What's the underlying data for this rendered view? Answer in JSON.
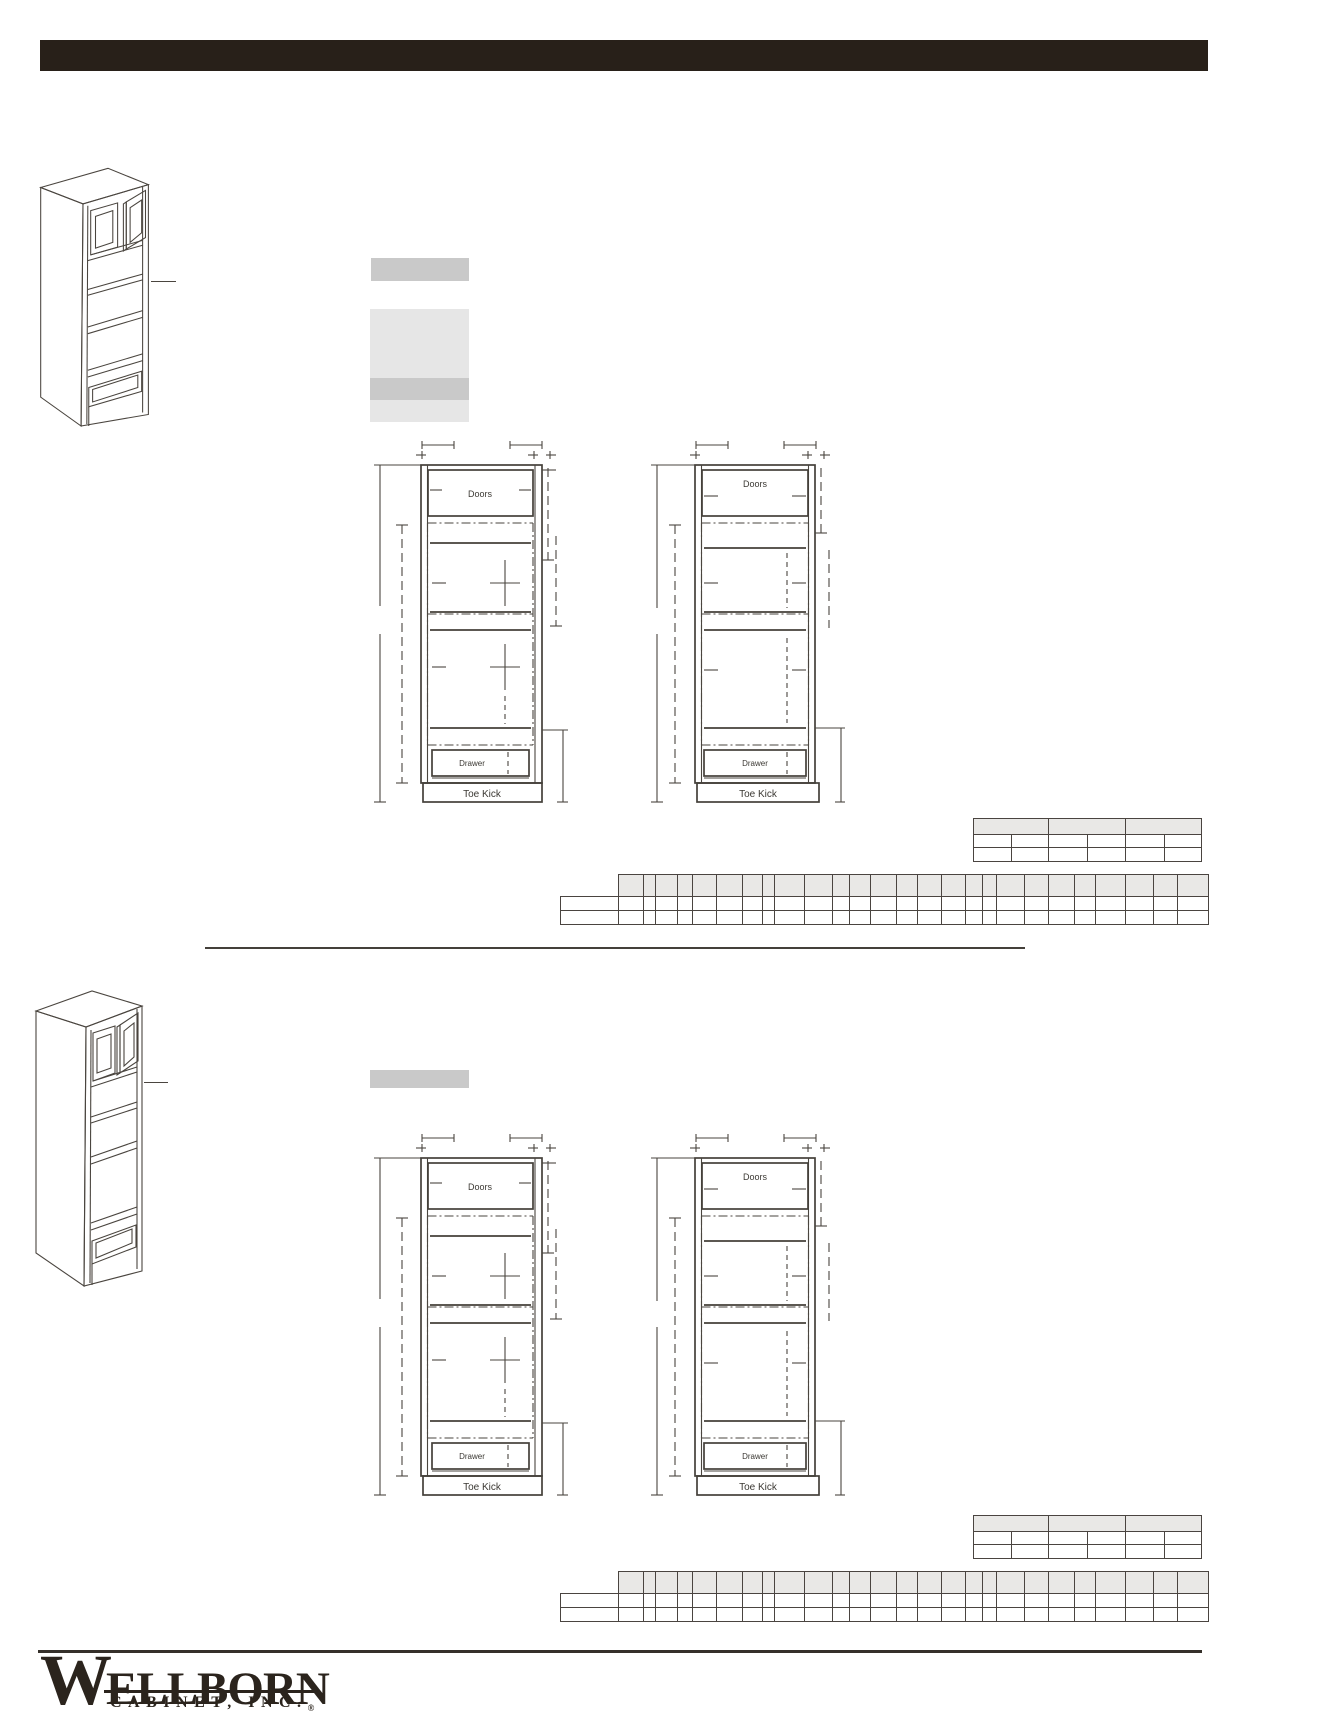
{
  "header_bar": {
    "color": "#282019"
  },
  "drawing_labels": {
    "doors": "Doors",
    "drawer": "Drawer",
    "toe_kick": "Toe Kick"
  },
  "tables": {
    "dimension_table": {
      "merged_header_cells": 3,
      "columns": 6,
      "data_rows": 2,
      "cells_empty": true
    },
    "spec_table": {
      "header_columns": 26,
      "has_unheaded_label_column": true,
      "data_rows": 2,
      "cells_empty": true
    }
  },
  "logo": {
    "initial": "W",
    "name_rest": "ELLBORN",
    "line2": "CABINET, INC.",
    "registered_mark": "®"
  },
  "colors": {
    "header_bar": "#282019",
    "line_work": "#4a453f",
    "table_border": "#4a4440",
    "table_header_fill": "#e9e8e6",
    "redaction_dark": "#c9c9c9",
    "redaction_light": "#e6e6e6",
    "logo": "#2b241d"
  }
}
